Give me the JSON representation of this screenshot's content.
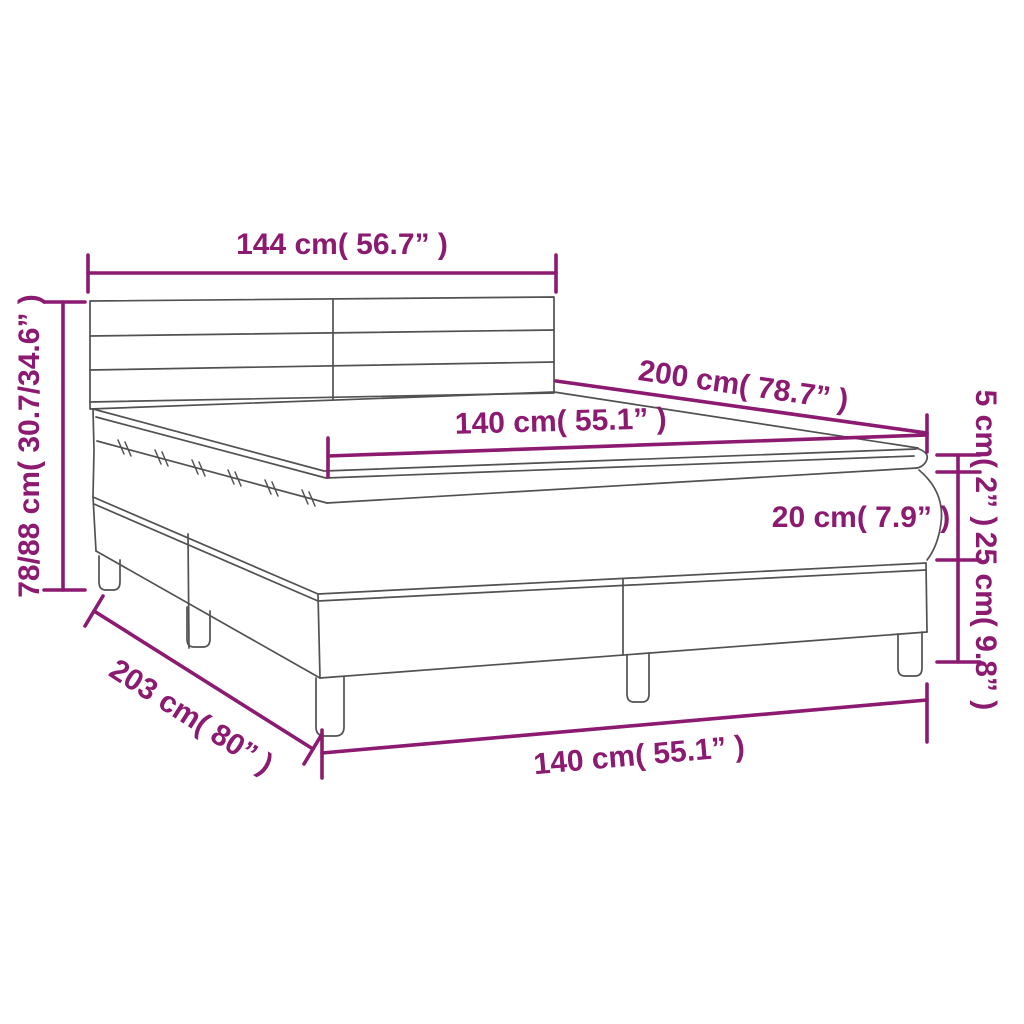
{
  "diagram": {
    "accent_color": "#8b1a70",
    "outline_color": "#515151",
    "labels": {
      "headboard_width": "144 cm( 56.7” )",
      "bed_height": "78/88 cm( 30.7/34.6” )",
      "sleeping_length": "200 cm( 78.7” )",
      "sleeping_width": "140 cm( 55.1” )",
      "topper_thickness": "5 cm( 2” )",
      "mattress_thickness": "20 cm( 7.9” )",
      "base_height": "25 cm( 9.8” )",
      "bed_length": "203 cm( 80” )",
      "bed_width": "140 cm( 55.1” )"
    }
  }
}
